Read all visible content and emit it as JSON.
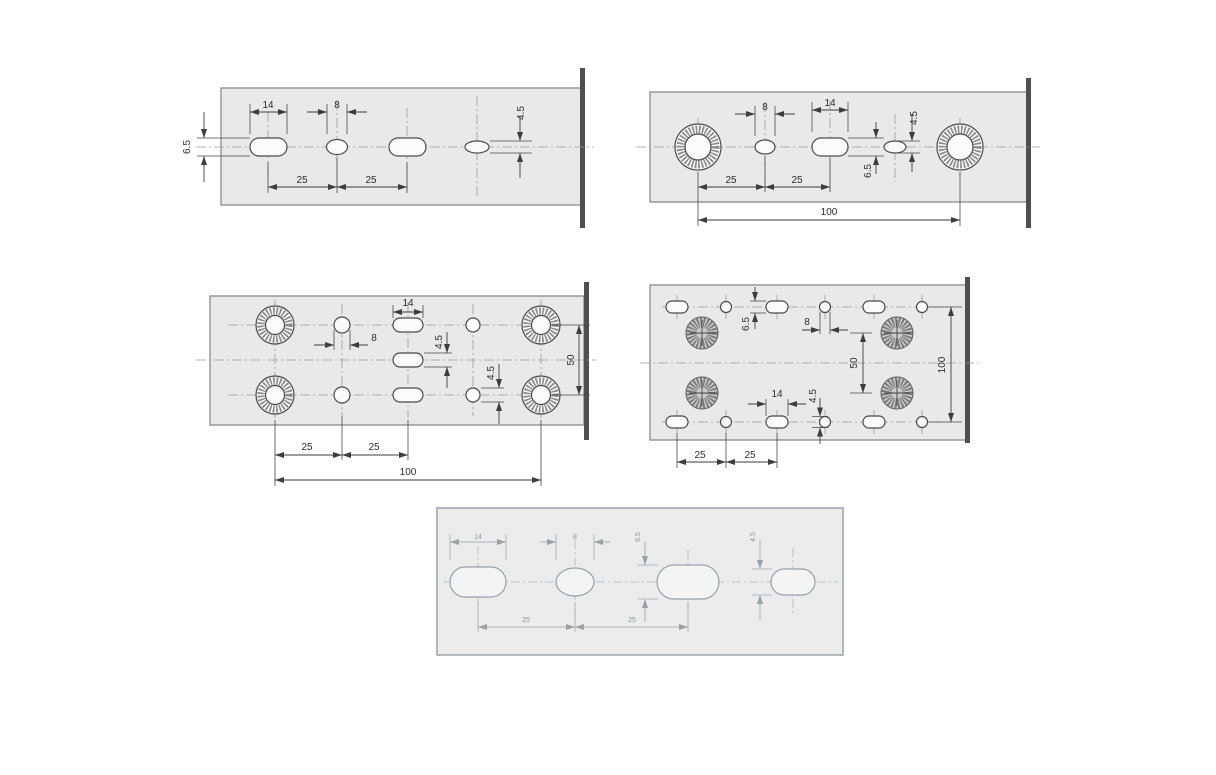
{
  "style": {
    "background": "#ffffff",
    "plate_fill": "#e9e9e9",
    "line_color": "#4a4a4a",
    "centerline_color": "#9a9a9a",
    "dim_text_color": "#2d2d2d",
    "cut_line_color": "#4f4f4f",
    "faded_color": "#9aa0a4"
  },
  "panels": [
    {
      "id": "top-left-strip",
      "labels": {
        "slot_width": "14",
        "hole_width": "8",
        "hole_height": "4.5",
        "slot_height": "6.5",
        "pitch_a": "25",
        "pitch_b": "25"
      }
    },
    {
      "id": "top-right-strip",
      "labels": {
        "hole_width": "8",
        "slot_width": "14",
        "hole_height": "4.5",
        "slot_height": "6.5",
        "pitch_a": "25",
        "pitch_b": "25",
        "overall_length": "100"
      }
    },
    {
      "id": "middle-left-plate",
      "labels": {
        "slot_width": "14",
        "hole_width": "8",
        "slot_height": "4.5",
        "hole_height": "4.5",
        "row_spacing": "50",
        "pitch_a": "25",
        "pitch_b": "25",
        "overall_length": "100"
      }
    },
    {
      "id": "middle-right-plate",
      "labels": {
        "slot_height": "6.5",
        "hole_width": "8",
        "row_spacing": "50",
        "overall_height": "100",
        "slot_width": "14",
        "hole_height": "4.5",
        "pitch_a": "25",
        "pitch_b": "25"
      }
    },
    {
      "id": "bottom-strip",
      "labels": {
        "slot_width": "14",
        "hole_width": "8",
        "slot_height": "6.5",
        "hole_height": "4.5",
        "pitch_a": "25",
        "pitch_b": "25"
      }
    }
  ]
}
